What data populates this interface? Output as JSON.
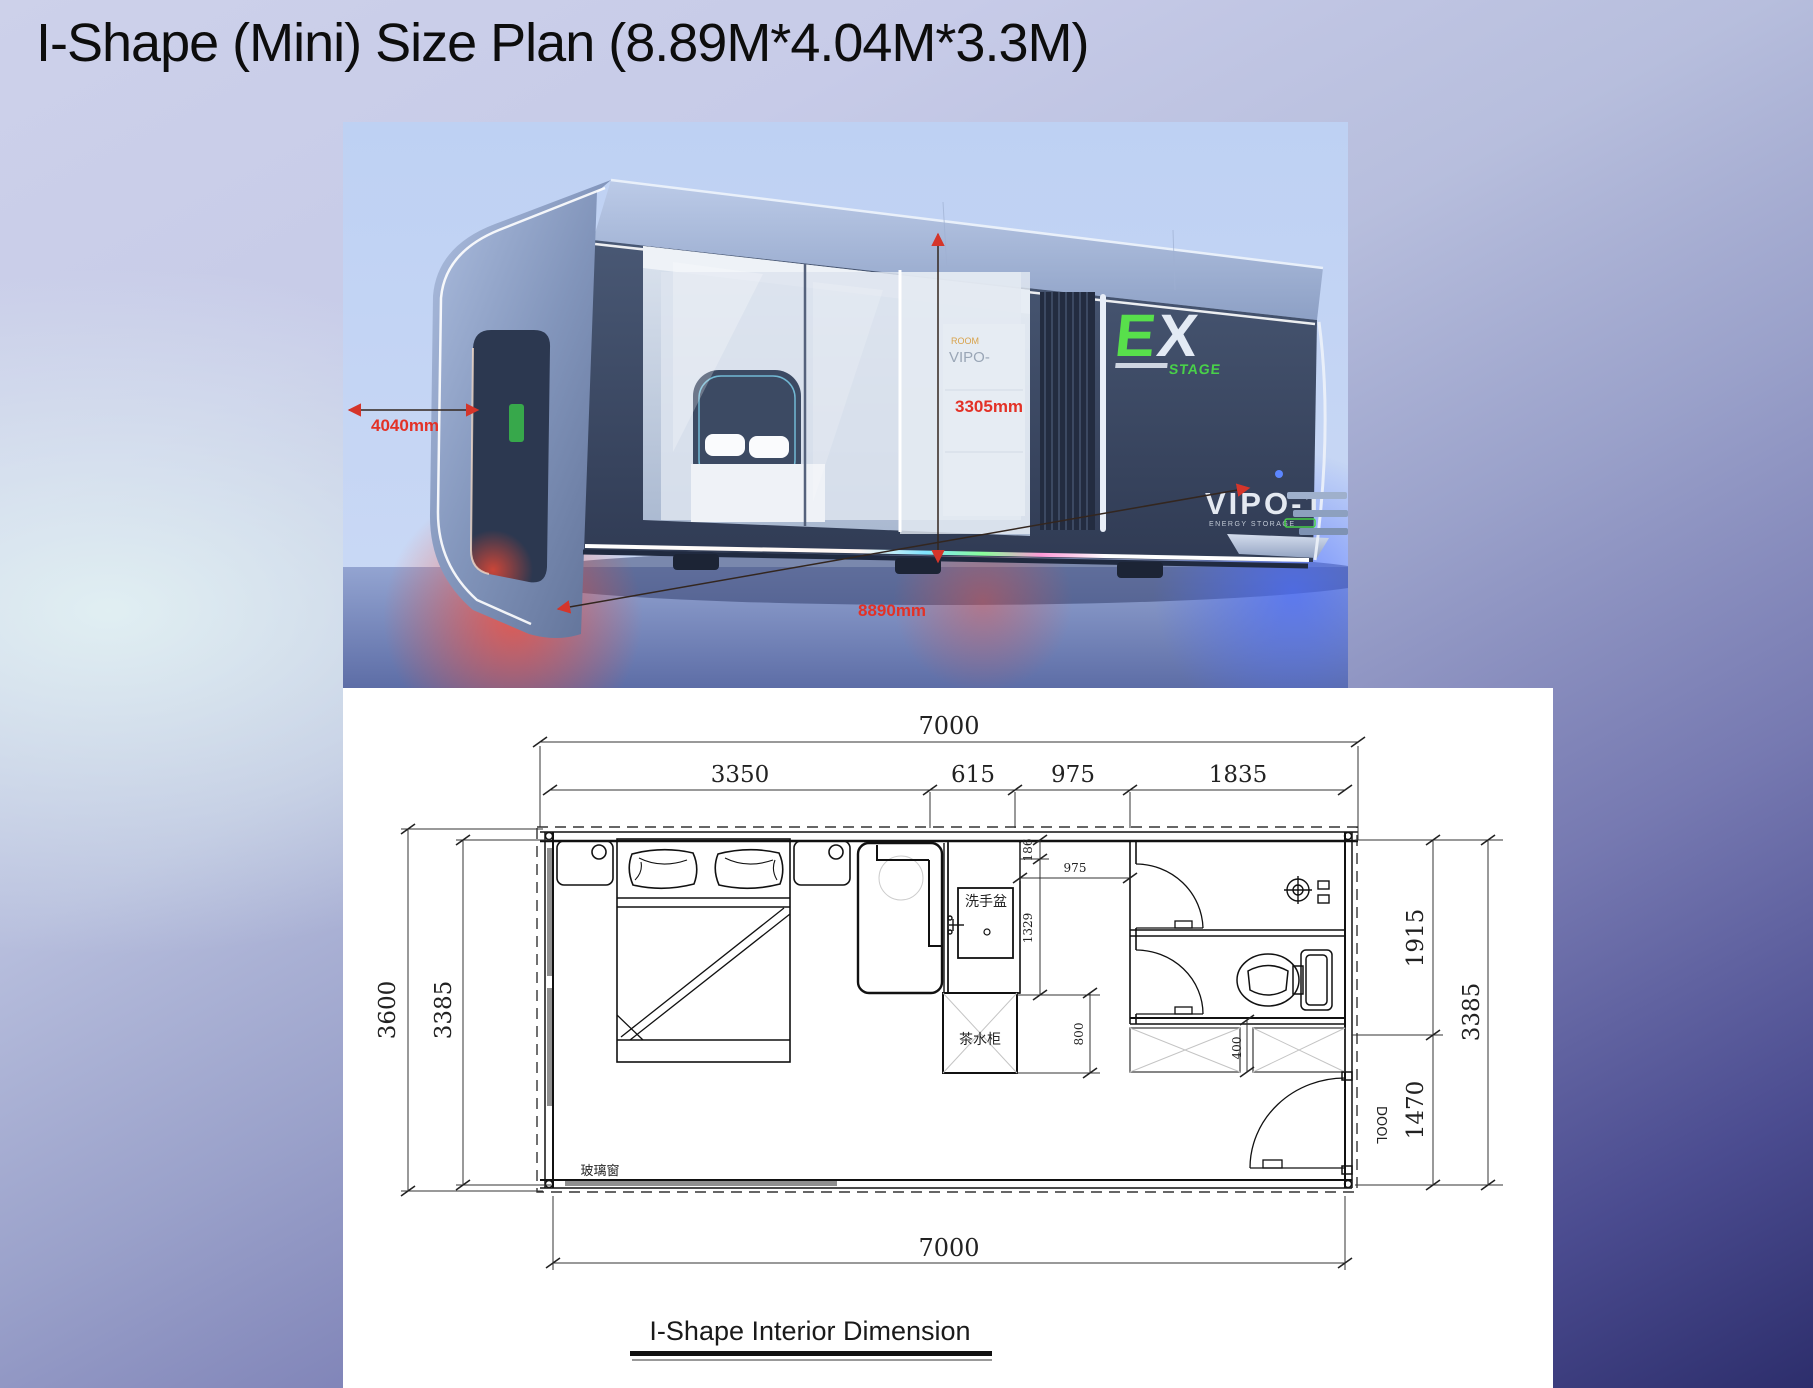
{
  "slide": {
    "title": "I-Shape (Mini) Size Plan (8.89M*4.04M*3.3M)",
    "caption": "I-Shape Interior Dimension"
  },
  "render": {
    "logo_e": "E",
    "logo_x": "X",
    "logo_sub": "STAGE",
    "model": "VIPO-1",
    "model_tagline": "ENERGY STORAGE",
    "glass_tag_top": "ROOM",
    "glass_tag": "VIPO-",
    "dim_width": "4040mm",
    "dim_height": "3305mm",
    "dim_length": "8890mm"
  },
  "plan": {
    "top_total": "7000",
    "bottom_total": "7000",
    "seg_3350": "3350",
    "seg_615": "615",
    "seg_975": "975",
    "seg_1835": "1835",
    "left_outer": "3600",
    "left_inner": "3385",
    "right_top": "1915",
    "right_outer": "3385",
    "right_bottom": "1470",
    "inner_186": "186",
    "inner_975": "975",
    "inner_1329": "1329",
    "inner_800": "800",
    "inner_400": "400",
    "label_basin": "洗手盆",
    "label_tea_cabinet": "茶水柜",
    "label_window": "玻璃窗",
    "label_door": "DOOL"
  },
  "colors": {
    "dim_red": "#e33126",
    "logo_green": "#55dd4a",
    "panel_white": "#ffffff",
    "body_dark": "#3e4c69"
  }
}
